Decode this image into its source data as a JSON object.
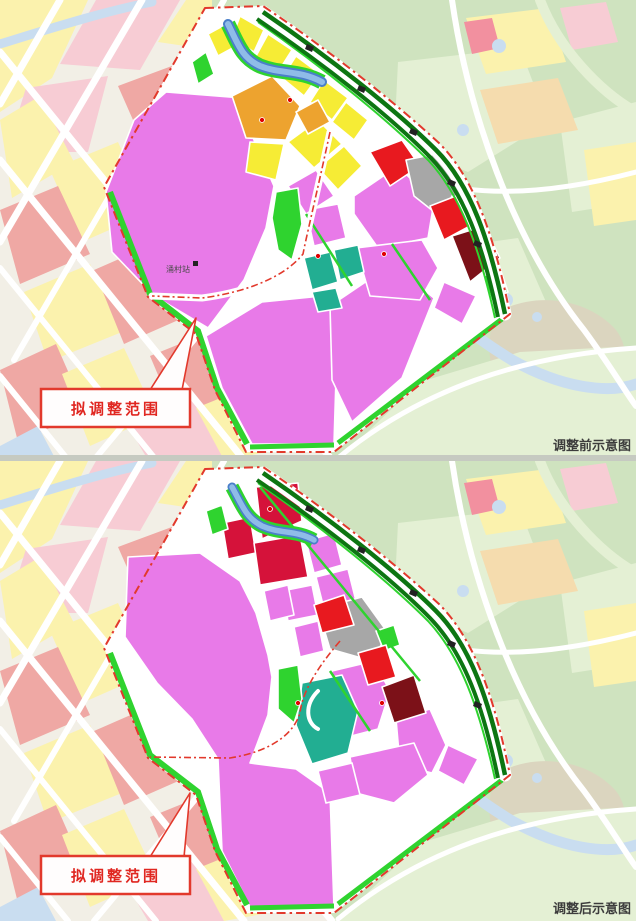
{
  "figure": {
    "type": "planning-zoning-comparison-map",
    "panels": [
      {
        "id": "before",
        "caption": "调整前示意图",
        "callout": "拟调整范围",
        "station_label": "涌村站"
      },
      {
        "id": "after",
        "caption": "调整后示意图",
        "callout": "拟调整范围"
      }
    ],
    "colors": {
      "base_bg": "#f2efe6",
      "base_yellow": "#fbf2ad",
      "base_pink": "#f7ccd4",
      "base_pinkhot": "#f2909f",
      "base_salmon": "#efa8a4",
      "base_peach": "#f5dcae",
      "base_green": "#cfe3bf",
      "base_green2": "#e4f0d4",
      "base_beige": "#dbd5bf",
      "base_blue": "#c9ddf0",
      "road_white": "#ffffff",
      "parcel_pink": "#e87ae8",
      "parcel_yellow": "#f6ec35",
      "parcel_orange": "#eda32f",
      "parcel_green": "#2fd32f",
      "rail_green": "#0d7512",
      "parcel_teal": "#22ae92",
      "parcel_red": "#e8191f",
      "parcel_crimson": "#d5123a",
      "parcel_darkred": "#7c1118",
      "parcel_gray": "#a7a7a7",
      "parcel_gray2": "#8e8e8e",
      "river_blue": "#8fbce8",
      "river_edge": "#4a7fc9",
      "boundary_red": "#e2392c",
      "callout_red": "#e02721",
      "caption_color": "#3c3c3c",
      "label_color": "#4a4a4a",
      "station_dark": "#222222"
    }
  }
}
